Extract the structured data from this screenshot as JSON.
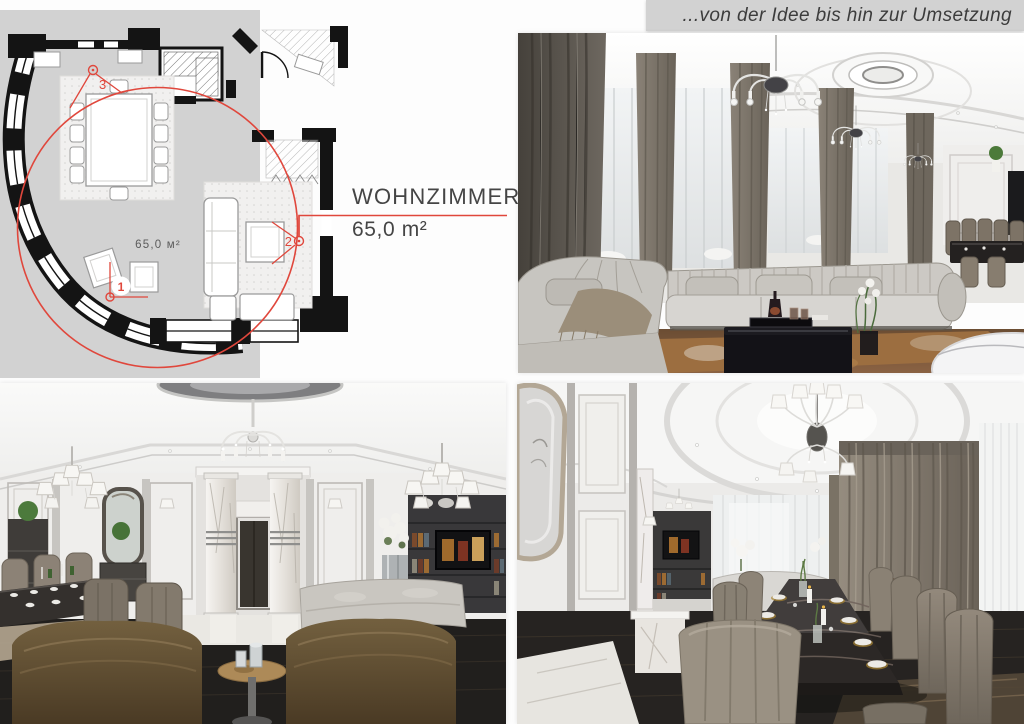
{
  "header": {
    "tagline": "...von der Idee bis hin zur Umsetzung",
    "strip_color": "#d2d2d2",
    "text_color": "#3c3c3c"
  },
  "plan": {
    "room_name": "WOHNZIMMER",
    "room_area": "65,0 m²",
    "area_label": "65,0 м²",
    "accent_color": "#e0473c",
    "backdrop_color": "#d2d2d2",
    "markers": [
      {
        "number": "1"
      },
      {
        "number": "2"
      },
      {
        "number": "3"
      }
    ]
  }
}
